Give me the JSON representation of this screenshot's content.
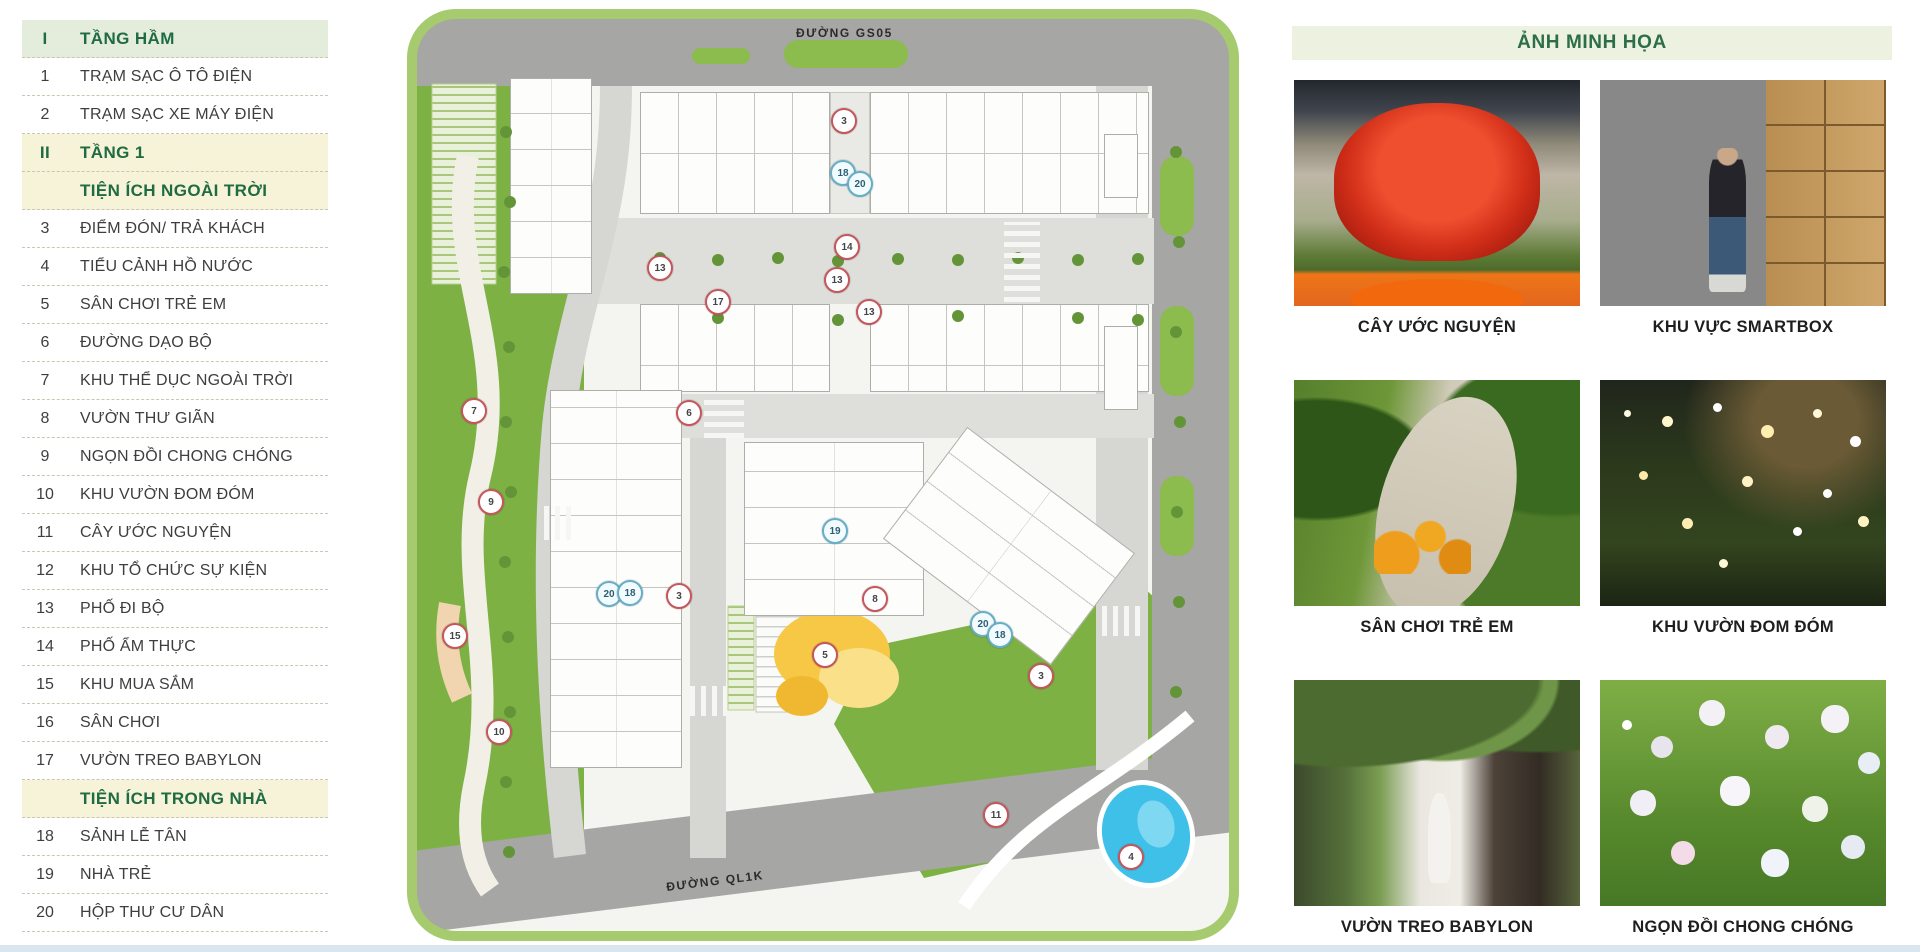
{
  "legend": {
    "rows": [
      {
        "num": "I",
        "label": "TẦNG HẦM",
        "variant": "header-green"
      },
      {
        "num": "1",
        "label": "TRẠM SẠC Ô TÔ ĐIỆN",
        "variant": "item"
      },
      {
        "num": "2",
        "label": "TRẠM SẠC XE MÁY ĐIỆN",
        "variant": "item"
      },
      {
        "num": "II",
        "label": "TẦNG 1",
        "variant": "header-cream"
      },
      {
        "num": "",
        "label": "TIỆN ÍCH NGOÀI TRỜI",
        "variant": "header-cream"
      },
      {
        "num": "3",
        "label": "ĐIỂM ĐÓN/ TRẢ KHÁCH",
        "variant": "item"
      },
      {
        "num": "4",
        "label": "TIỂU CẢNH HỒ NƯỚC",
        "variant": "item"
      },
      {
        "num": "5",
        "label": "SÂN CHƠI TRẺ EM",
        "variant": "item"
      },
      {
        "num": "6",
        "label": "ĐƯỜNG DẠO BỘ",
        "variant": "item"
      },
      {
        "num": "7",
        "label": "KHU THỂ DỤC NGOÀI TRỜI",
        "variant": "item"
      },
      {
        "num": "8",
        "label": "VƯỜN THƯ GIÃN",
        "variant": "item"
      },
      {
        "num": "9",
        "label": "NGỌN ĐỒI CHONG CHÓNG",
        "variant": "item"
      },
      {
        "num": "10",
        "label": "KHU VƯỜN ĐOM ĐÓM",
        "variant": "item"
      },
      {
        "num": "11",
        "label": "CÂY ƯỚC NGUYỆN",
        "variant": "item"
      },
      {
        "num": "12",
        "label": "KHU TỔ CHỨC SỰ KIỆN",
        "variant": "item"
      },
      {
        "num": "13",
        "label": "PHỐ ĐI BỘ",
        "variant": "item"
      },
      {
        "num": "14",
        "label": "PHỐ ẨM THỰC",
        "variant": "item"
      },
      {
        "num": "15",
        "label": "KHU MUA SẮM",
        "variant": "item"
      },
      {
        "num": "16",
        "label": "SÂN CHƠI",
        "variant": "item"
      },
      {
        "num": "17",
        "label": "VƯỜN TREO BABYLON",
        "variant": "item"
      },
      {
        "num": "",
        "label": "TIỆN ÍCH TRONG NHÀ",
        "variant": "header-cream"
      },
      {
        "num": "18",
        "label": "SẢNH LỄ TÂN",
        "variant": "item"
      },
      {
        "num": "19",
        "label": "NHÀ TRẺ",
        "variant": "item"
      },
      {
        "num": "20",
        "label": "HỘP THƯ CƯ DÂN",
        "variant": "item"
      }
    ]
  },
  "site_plan": {
    "road_labels": {
      "top": "ĐƯỜNG GS05",
      "bottom": "ĐƯỜNG QL1K"
    },
    "markers": [
      {
        "num": "3",
        "x": 438,
        "y": 113,
        "variant": "red"
      },
      {
        "num": "18",
        "x": 437,
        "y": 165,
        "variant": "teal"
      },
      {
        "num": "20",
        "x": 454,
        "y": 176,
        "variant": "teal"
      },
      {
        "num": "14",
        "x": 441,
        "y": 239,
        "variant": "red"
      },
      {
        "num": "13",
        "x": 254,
        "y": 260,
        "variant": "red"
      },
      {
        "num": "13",
        "x": 431,
        "y": 272,
        "variant": "red"
      },
      {
        "num": "17",
        "x": 312,
        "y": 294,
        "variant": "red"
      },
      {
        "num": "13",
        "x": 463,
        "y": 304,
        "variant": "red"
      },
      {
        "num": "7",
        "x": 68,
        "y": 403,
        "variant": "red"
      },
      {
        "num": "6",
        "x": 283,
        "y": 405,
        "variant": "red"
      },
      {
        "num": "9",
        "x": 85,
        "y": 494,
        "variant": "red"
      },
      {
        "num": "19",
        "x": 429,
        "y": 523,
        "variant": "teal"
      },
      {
        "num": "20",
        "x": 203,
        "y": 586,
        "variant": "teal"
      },
      {
        "num": "18",
        "x": 224,
        "y": 585,
        "variant": "teal"
      },
      {
        "num": "3",
        "x": 273,
        "y": 588,
        "variant": "red"
      },
      {
        "num": "8",
        "x": 469,
        "y": 591,
        "variant": "red"
      },
      {
        "num": "20",
        "x": 577,
        "y": 616,
        "variant": "teal"
      },
      {
        "num": "18",
        "x": 594,
        "y": 627,
        "variant": "teal"
      },
      {
        "num": "15",
        "x": 49,
        "y": 628,
        "variant": "red"
      },
      {
        "num": "5",
        "x": 419,
        "y": 647,
        "variant": "red"
      },
      {
        "num": "3",
        "x": 635,
        "y": 668,
        "variant": "red"
      },
      {
        "num": "10",
        "x": 93,
        "y": 724,
        "variant": "red"
      },
      {
        "num": "11",
        "x": 590,
        "y": 807,
        "variant": "red"
      },
      {
        "num": "4",
        "x": 725,
        "y": 849,
        "variant": "red"
      }
    ]
  },
  "gallery": {
    "title": "ẢNH MINH HỌA",
    "photos": [
      {
        "num": "1",
        "caption": "CÂY ƯỚC NGUYỆN",
        "variant": "ph-tree"
      },
      {
        "num": "2",
        "caption": "KHU VỰC SMARTBOX",
        "variant": "ph-smartbox"
      },
      {
        "num": "3",
        "caption": "SÂN CHƠI TRẺ EM",
        "variant": "ph-playground"
      },
      {
        "num": "4",
        "caption": "KHU VƯỜN ĐOM ĐÓM",
        "variant": "ph-firefly"
      },
      {
        "num": "5",
        "caption": "VƯỜN TREO BABYLON",
        "variant": "ph-babylon"
      },
      {
        "num": "6",
        "caption": "NGỌN ĐỒI CHONG CHÓNG",
        "variant": "ph-pinwheel"
      }
    ]
  },
  "colors": {
    "accent_green": "#1f6b42",
    "lawn_green": "#7db144",
    "road_gray": "#a6a6a4",
    "frame_green": "#a6ca6e",
    "marker_red": "#c4565c",
    "marker_teal": "#66aec6",
    "pond_blue": "#3fc0e8",
    "playground_yellow": "#f6c845",
    "header_band": "#edf1df"
  }
}
